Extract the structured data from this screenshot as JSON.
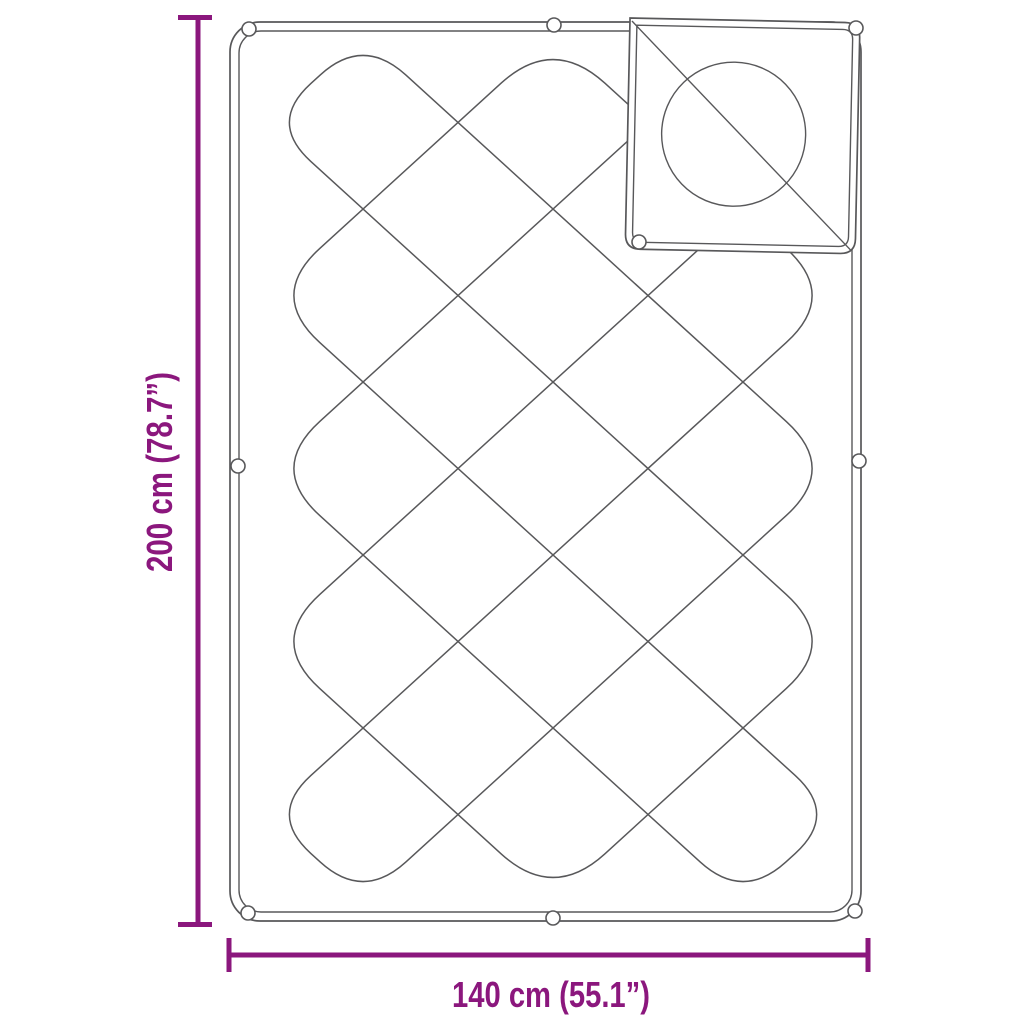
{
  "page": {
    "type": "product-dimension-diagram",
    "background": "#ffffff"
  },
  "product": {
    "name": "quilted-blanket-with-folded-corner",
    "pattern": "diamond-quilting",
    "grommet_count": 9
  },
  "dimensions": {
    "height": {
      "label": "200 cm (78.7”)",
      "cm": 200,
      "inches": 78.7
    },
    "width": {
      "label": "140 cm (55.1”)",
      "cm": 140,
      "inches": 55.1
    }
  },
  "colors": {
    "dimension_accent": "#8b177d",
    "outline": "#58585a",
    "background": "#ffffff"
  }
}
